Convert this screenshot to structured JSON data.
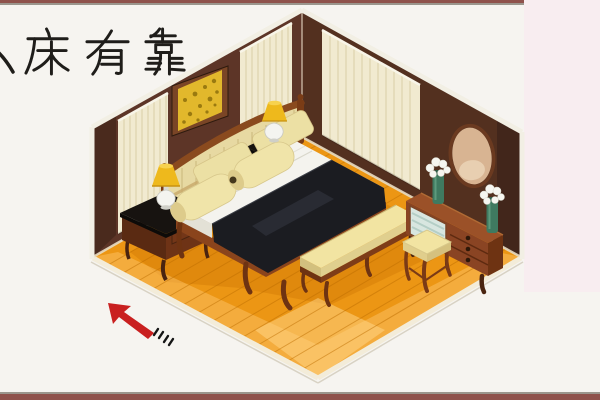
{
  "caption": {
    "text": "床有靠",
    "partial_left_char": "clipped stroke of preceding character at left edge",
    "color": "#1f1d1a"
  },
  "scene": {
    "type": "isometric-bedroom-illustration",
    "elements": [
      "left-wall",
      "right-wall",
      "wood-floor",
      "window-blinds-left-a",
      "window-blinds-left-b",
      "window-blinds-right",
      "picture-frame",
      "wall-mirror",
      "headboard",
      "double-bed",
      "white-sheet",
      "dark-bedspread",
      "pillows",
      "nightstand-left",
      "nightstand-right",
      "table-lamp-left",
      "table-lamp-right",
      "foot-bench",
      "dressing-table",
      "flower-vase-left",
      "flower-vase-right",
      "stool",
      "red-arrow"
    ]
  },
  "colors": {
    "wall_left": "#5d3527",
    "wall_right": "#53301f",
    "wall_dark": "#45271c",
    "floor": "#ec9614",
    "floor_light": "#f3aa3e",
    "blinds": "#f1ead0",
    "blind_stripe": "#d9cfa6",
    "picture_frame": "#7a4526",
    "art": "#e2b82c",
    "headboard": "#e7d9a2",
    "wood": "#8a4423",
    "wood_dark": "#5e2a10",
    "nightstand_top": "#171310",
    "spread": "#1b1c21",
    "sheet": "#f4f3ee",
    "pillow": "#f0e4a9",
    "lamp_shade": "#eeb91c",
    "lamp_base": "#f4f4f0",
    "mirror_face": "#d8b492",
    "vase": "#3f7a60",
    "cushion": "#f2e4a2",
    "arrow": "#c92020",
    "trim": "#f2efe4",
    "border_red": "#8f524c",
    "border_gray": "#9b968d"
  }
}
